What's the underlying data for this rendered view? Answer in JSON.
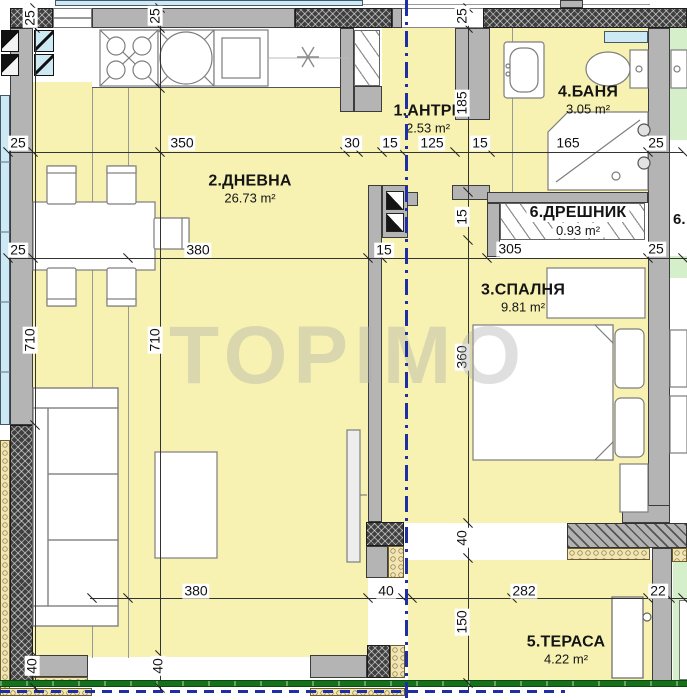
{
  "watermark": "TOPIMO",
  "rooms": {
    "antre": {
      "name": "1.АНТРЕ",
      "area": "2.53 m²"
    },
    "dnevna": {
      "name": "2.ДНЕВНА",
      "area": "26.73 m²"
    },
    "banya": {
      "name": "4.БАНЯ",
      "area": "3.05 m²"
    },
    "dreshnik": {
      "name": "6.ДРЕШНИК",
      "area": "0.93 m²"
    },
    "spalnya": {
      "name": "3.СПАЛНЯ",
      "area": "9.81 m²"
    },
    "terasa": {
      "name": "5.ТЕРАСА",
      "area": "4.22 m²"
    }
  },
  "neighbor_label": "6.",
  "dimensions": [
    {
      "v": "25",
      "x": 18,
      "y": 143,
      "r": 0
    },
    {
      "v": "350",
      "x": 182,
      "y": 143,
      "r": 0
    },
    {
      "v": "30",
      "x": 352,
      "y": 143,
      "r": 0
    },
    {
      "v": "15",
      "x": 390,
      "y": 143,
      "r": 0
    },
    {
      "v": "125",
      "x": 432,
      "y": 143,
      "r": 0
    },
    {
      "v": "15",
      "x": 480,
      "y": 143,
      "r": 0
    },
    {
      "v": "165",
      "x": 568,
      "y": 143,
      "r": 0
    },
    {
      "v": "25",
      "x": 656,
      "y": 143,
      "r": 0
    },
    {
      "v": "25",
      "x": 18,
      "y": 250,
      "r": 0
    },
    {
      "v": "380",
      "x": 198,
      "y": 250,
      "r": 0
    },
    {
      "v": "15",
      "x": 384,
      "y": 250,
      "r": 0
    },
    {
      "v": "305",
      "x": 510,
      "y": 249,
      "r": 0
    },
    {
      "v": "25",
      "x": 656,
      "y": 249,
      "r": 0
    },
    {
      "v": "380",
      "x": 196,
      "y": 591,
      "r": 0
    },
    {
      "v": "40",
      "x": 386,
      "y": 591,
      "r": 0
    },
    {
      "v": "282",
      "x": 524,
      "y": 591,
      "r": 0
    },
    {
      "v": "22",
      "x": 658,
      "y": 591,
      "r": 0
    },
    {
      "v": "25",
      "x": 30,
      "y": 18,
      "r": 1
    },
    {
      "v": "710",
      "x": 30,
      "y": 340,
      "r": 1
    },
    {
      "v": "40",
      "x": 32,
      "y": 666,
      "r": 1
    },
    {
      "v": "25",
      "x": 155,
      "y": 16,
      "r": 1
    },
    {
      "v": "710",
      "x": 155,
      "y": 340,
      "r": 1
    },
    {
      "v": "40",
      "x": 158,
      "y": 666,
      "r": 1
    },
    {
      "v": "25",
      "x": 462,
      "y": 16,
      "r": 1
    },
    {
      "v": "185",
      "x": 462,
      "y": 103,
      "r": 1
    },
    {
      "v": "15",
      "x": 462,
      "y": 217,
      "r": 1
    },
    {
      "v": "360",
      "x": 462,
      "y": 357,
      "r": 1
    },
    {
      "v": "40",
      "x": 462,
      "y": 538,
      "r": 1
    },
    {
      "v": "150",
      "x": 462,
      "y": 622,
      "r": 1
    }
  ],
  "colors": {
    "floor": "#f7f2b2",
    "neighbor_floor": "#d6efcb",
    "wall": "#b4b4b4",
    "window": "#cde9f3",
    "railing": "#17701c",
    "section_line": "#1e2fa6"
  }
}
